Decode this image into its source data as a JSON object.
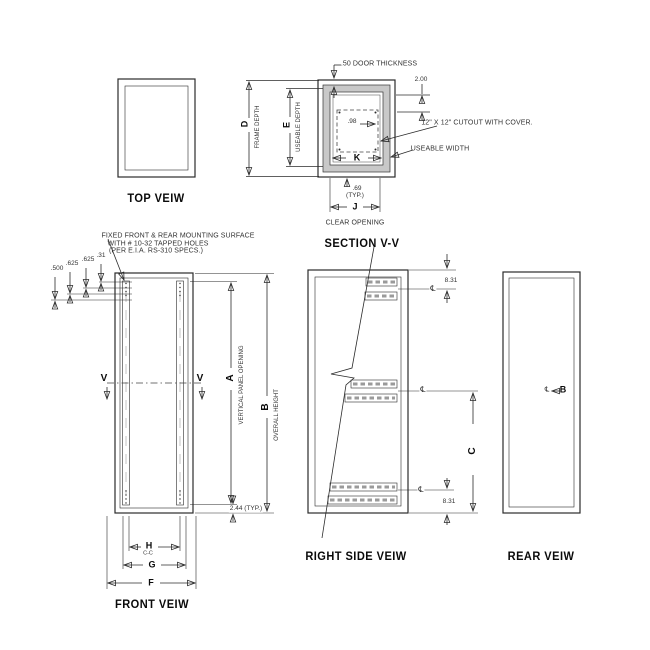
{
  "titles": {
    "top_view": "TOP VEIW",
    "section_vv": "SECTION V-V",
    "front_view": "FRONT VEIW",
    "right_side_view": "RIGHT SIDE VEIW",
    "rear_view": "REAR VEIW"
  },
  "section": {
    "door_thickness": ".50 DOOR THICKNESS",
    "dim_2_00": "2.00",
    "dim_98": ".98",
    "cutout_note": "12\" X 12\" CUTOUT WITH COVER.",
    "useable_width_label": "USEABLE WIDTH",
    "dim_k": "K",
    "dim_69": ".69",
    "typ": "(TYP.)",
    "dim_j": "J",
    "clear_opening_label": "CLEAR OPENING",
    "dim_d": "D",
    "frame_depth_label": "FRAME DEPTH",
    "dim_e": "E",
    "useable_depth_label": "USEABLE DEPTH"
  },
  "front": {
    "note_line1": "FIXED FRONT & REAR MOUNTING SURFACE",
    "note_line2": "WITH # 10-32 TAPPED HOLES",
    "note_line3": "(PER E.I.A. RS-310 SPECS.)",
    "dim_500": ".500",
    "dim_625_a": ".625",
    "dim_625_b": ".625",
    "dim_31": ".31",
    "section_cut_letter": "V",
    "dim_a": "A",
    "vertical_panel_opening_label": "VERTICAL PANEL OPENING",
    "dim_b": "B",
    "overall_height_label": "OVERALL HEIGHT",
    "dim_244": "2.44 (TYP.)",
    "dim_h": "H",
    "center_to_center": "C-C",
    "dim_g": "G",
    "dim_f": "F"
  },
  "side": {
    "dim_831_top": "8.31",
    "dim_831_bottom": "8.31",
    "dim_c": "C",
    "centerline_symbol": "℄"
  },
  "rear": {
    "centerline_symbol": "℄",
    "dim_b": "B"
  },
  "colors": {
    "line": "#2b2b2b",
    "wall_hatch": "#c8c8c8",
    "background": "#ffffff"
  }
}
